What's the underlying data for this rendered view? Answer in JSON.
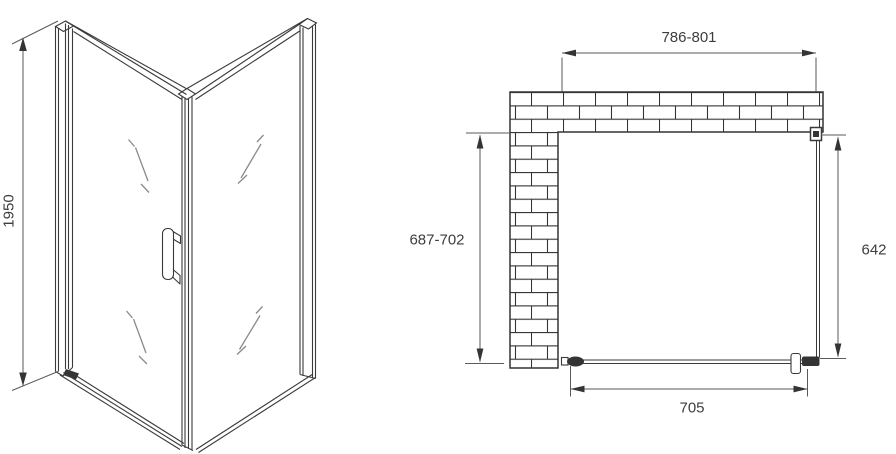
{
  "drawing": {
    "front_view": {
      "height_dimension": "1950"
    },
    "plan_view": {
      "top_width_dimension": "786-801",
      "wall_depth_dimension": "687-702",
      "glass_panel_dimension": "642",
      "door_width_dimension": "705"
    }
  },
  "colors": {
    "line": "#3a3a3a",
    "dim": "#5a5a5a",
    "text": "#3d3d3d",
    "mark": "#8a8a8a",
    "dark": "#343434",
    "bg": "#ffffff"
  }
}
